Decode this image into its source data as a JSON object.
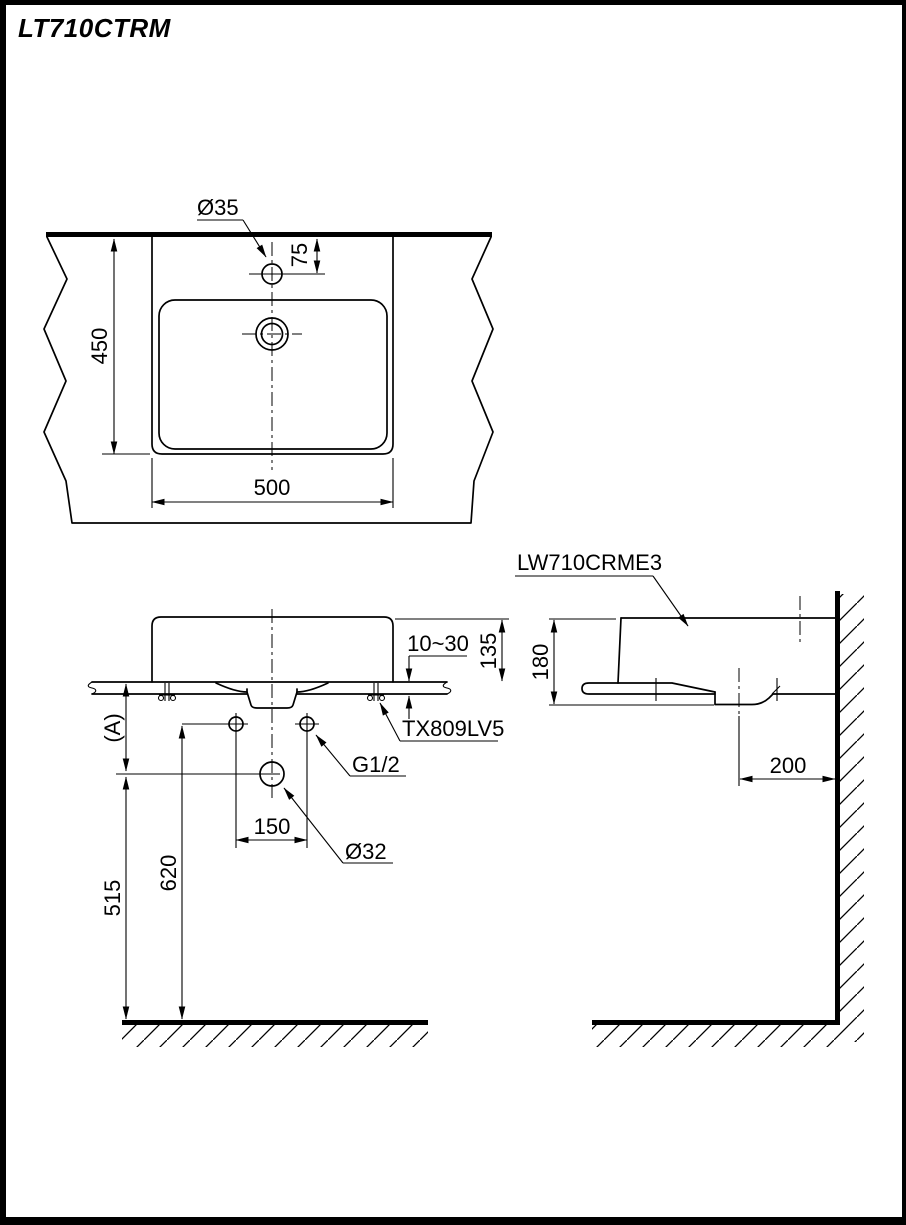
{
  "page": {
    "title": "LT710CTRM"
  },
  "top_view": {
    "faucet_hole_dia": "Ø35",
    "faucet_hole_offset": "75",
    "depth": "450",
    "width": "500"
  },
  "front_view": {
    "counter_thickness": "10~30",
    "height_above_counter": "135",
    "counter_height_ref": "(A)",
    "fixing_bolt_model": "TX809LV5",
    "supply_thread": "G1/2",
    "supply_hole_spacing": "150",
    "drain_hole_dia": "Ø32",
    "drain_height": "515",
    "supply_height": "620"
  },
  "side_view": {
    "basin_model": "LW710CRME3",
    "body_height": "180",
    "drain_offset_from_wall": "200"
  },
  "colors": {
    "line": "#000000",
    "background": "#ffffff"
  }
}
